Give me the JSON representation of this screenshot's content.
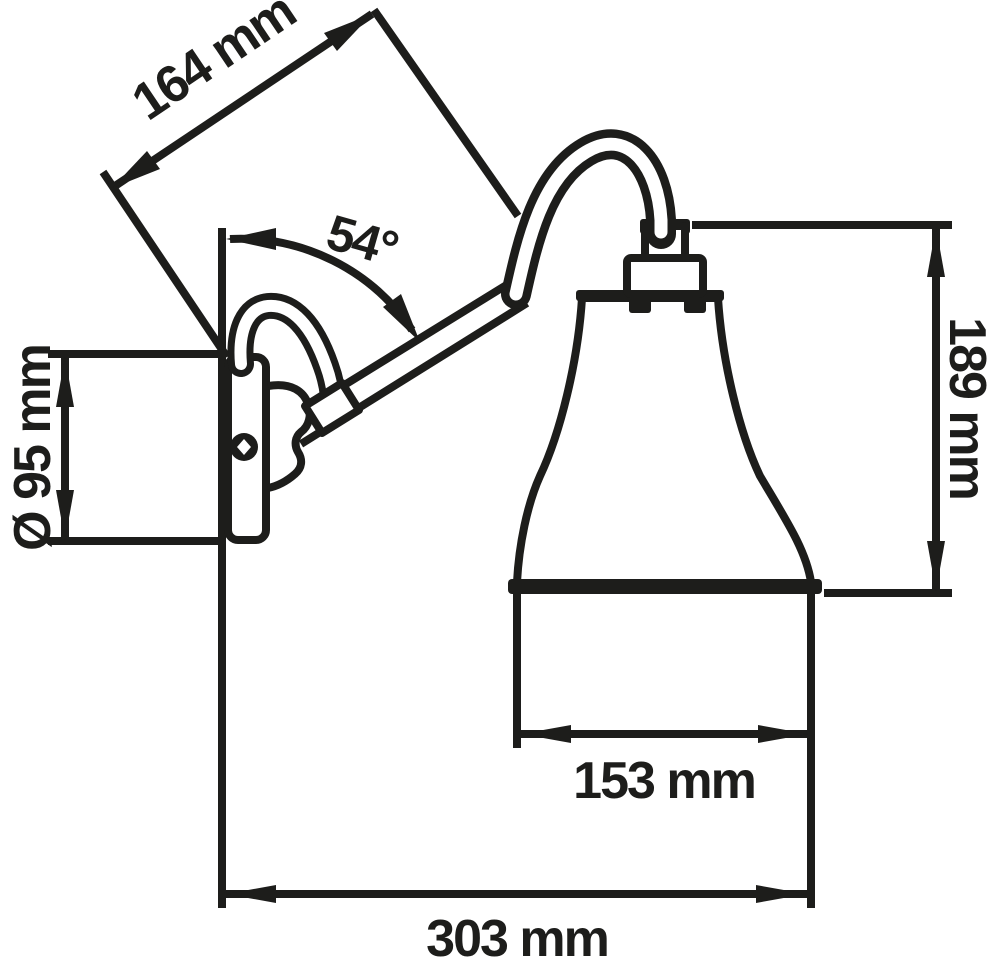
{
  "page": {
    "background": "#ffffff"
  },
  "drawing": {
    "subject": "wall lamp technical dimension drawing",
    "ink_color": "#1d1d1b",
    "dimensions": [
      {
        "id": "arm-length",
        "label": "164 mm",
        "value": 164,
        "unit": "mm"
      },
      {
        "id": "arm-angle",
        "label": "54°",
        "value": 54,
        "unit": "deg"
      },
      {
        "id": "wall-plate-diameter",
        "label": "Ø 95 mm",
        "value": 95,
        "unit": "mm"
      },
      {
        "id": "height",
        "label": "189 mm",
        "value": 189,
        "unit": "mm"
      },
      {
        "id": "shade-diameter",
        "label": "153 mm",
        "value": 153,
        "unit": "mm"
      },
      {
        "id": "projection",
        "label": "303 mm",
        "value": 303,
        "unit": "mm"
      }
    ]
  }
}
